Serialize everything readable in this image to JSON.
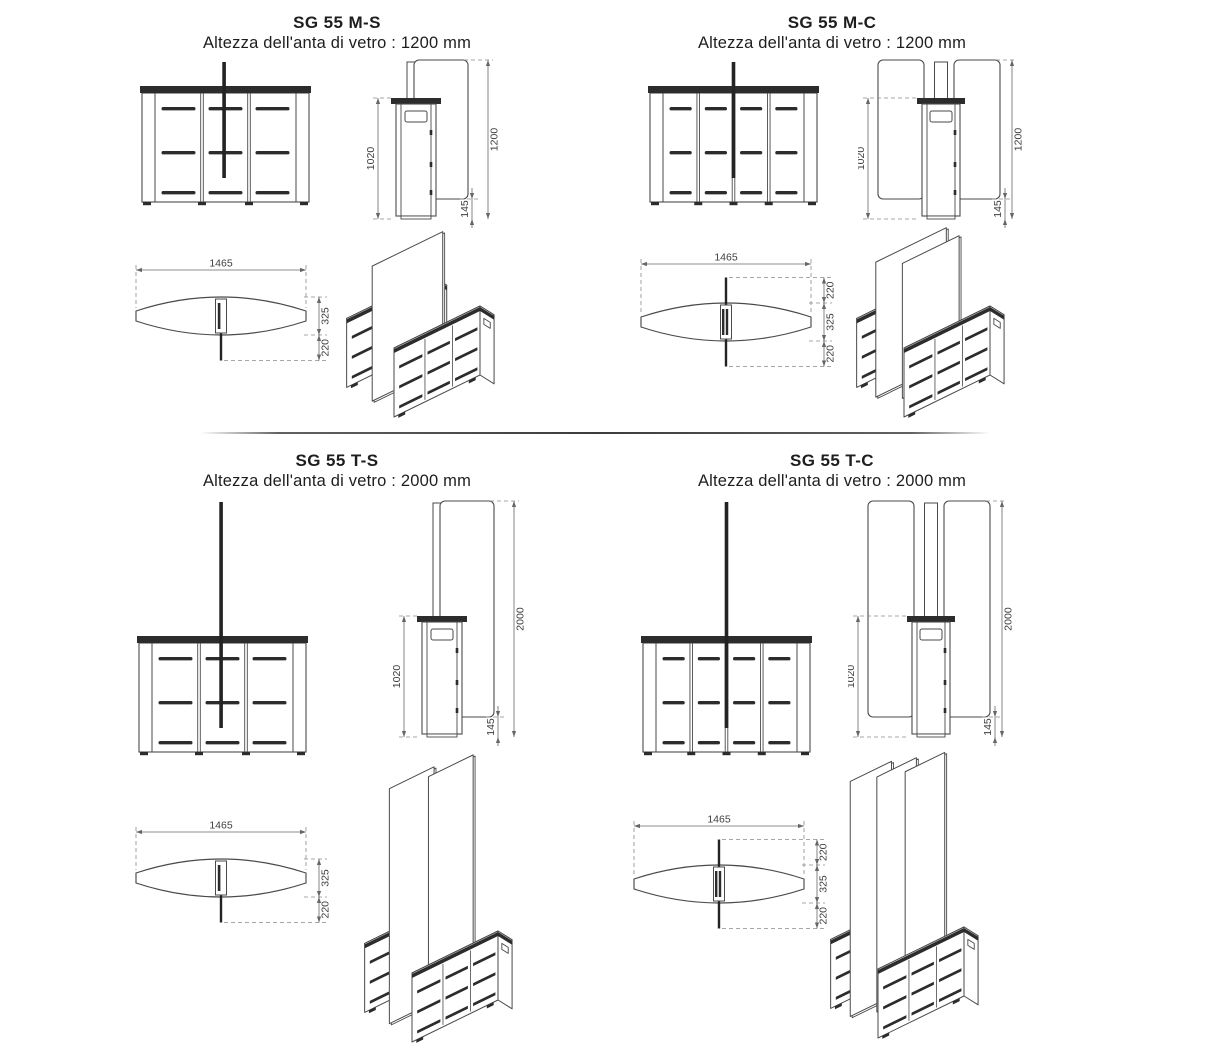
{
  "style": {
    "background": "#ffffff",
    "line": "#4a4a4a",
    "dark": "#2c2c2c",
    "pole": "#232323",
    "dim_line": "#666666",
    "dim_ext": "#8a8a8a",
    "dim_text": "#3e3e3e",
    "title_color": "#1e1e1e"
  },
  "models": [
    {
      "code": "SG 55 M-S",
      "subtitle": "Altezza dell'anta di vetro : 1200 mm",
      "size": "M",
      "config": "single-wing",
      "glass_height_mm": 1200,
      "dims": {
        "cabinet_height": "1020",
        "glass_height": "1200",
        "floor_clearance": "145",
        "length": "1465",
        "depth": "325",
        "wing_overhang": "220"
      }
    },
    {
      "code": "SG 55 M-C",
      "subtitle": "Altezza dell'anta di vetro : 1200 mm",
      "size": "M",
      "config": "double-wing",
      "glass_height_mm": 1200,
      "dims": {
        "cabinet_height": "1020",
        "glass_height": "1200",
        "floor_clearance": "145",
        "length": "1465",
        "depth": "325",
        "wing_overhang": "220"
      }
    },
    {
      "code": "SG 55 T-S",
      "subtitle": "Altezza dell'anta di vetro : 2000 mm",
      "size": "T",
      "config": "single-wing",
      "glass_height_mm": 2000,
      "dims": {
        "cabinet_height": "1020",
        "glass_height": "2000",
        "floor_clearance": "145",
        "length": "1465",
        "depth": "325",
        "wing_overhang": "220"
      }
    },
    {
      "code": "SG 55 T-C",
      "subtitle": "Altezza dell'anta di vetro : 2000 mm",
      "size": "T",
      "config": "double-wing",
      "glass_height_mm": 2000,
      "dims": {
        "cabinet_height": "1020",
        "glass_height": "2000",
        "floor_clearance": "145",
        "length": "1465",
        "depth": "325",
        "wing_overhang": "220"
      }
    }
  ]
}
